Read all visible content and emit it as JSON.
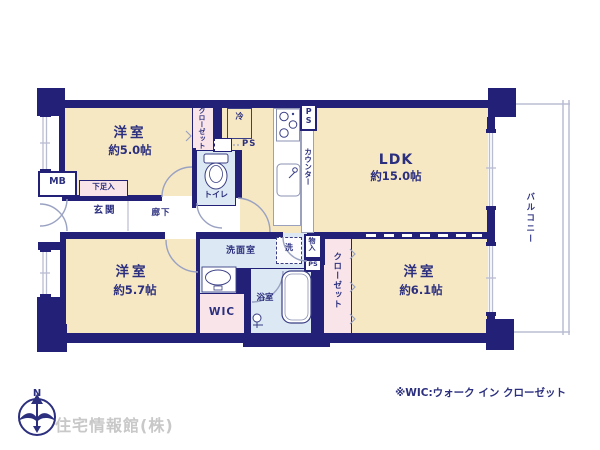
{
  "floorplan": {
    "rooms": {
      "bedroom_top_left": {
        "name": "洋室",
        "size": "約5.0帖"
      },
      "ldk": {
        "name": "LDK",
        "size": "約15.0帖"
      },
      "bedroom_bottom_left": {
        "name": "洋室",
        "size": "約5.7帖"
      },
      "bedroom_bottom_right": {
        "name": "洋室",
        "size": "約6.1帖"
      },
      "balcony": {
        "name": "バルコニー"
      },
      "entrance": {
        "name": "玄関"
      },
      "corridor": {
        "name": "廊下"
      },
      "toilet": {
        "name": "トイレ"
      },
      "washroom": {
        "name": "洗面室"
      },
      "bathroom": {
        "name": "浴室"
      },
      "wic": {
        "name": "WIC"
      }
    },
    "features": {
      "meter_box": "MB",
      "shoe_cabinet": "下足入",
      "closet_top": "クローゼット",
      "closet_bottom": "クローゼット",
      "counter": "カウンター",
      "refrigerator": "冷",
      "washing_machine": "洗",
      "storage": "物入",
      "pipe_space_kitchen": "PS",
      "pipe_space_fridge": "PS",
      "pipe_space_storage": "PS"
    },
    "compass": {
      "north_label": "N"
    },
    "footnote": "※WIC:ウォーク イン クローゼット",
    "company": "住宅情報館(株)",
    "colors": {
      "wall": "#232078",
      "room_fill": "#f7e8c4",
      "closet_fill": "#f9e4e9",
      "wet_area_fill": "#dce8f3",
      "text": "#2b2f7e",
      "railing": "#b9bdd2",
      "company_text": "#c8c8c8"
    }
  }
}
